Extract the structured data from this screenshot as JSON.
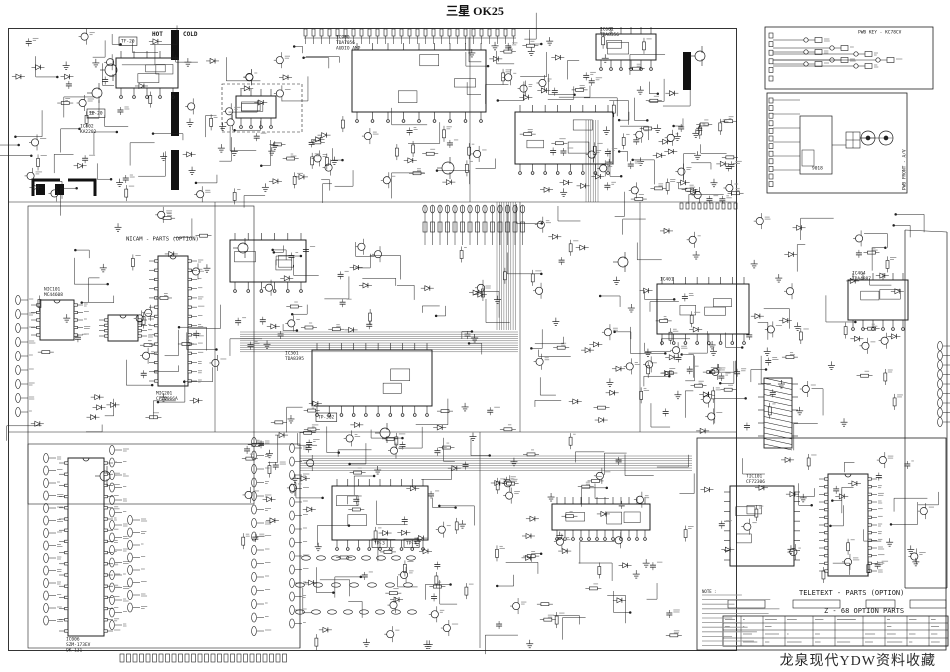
{
  "page": {
    "title": "三星 OK25",
    "watermark": "龙泉现代YDW资料收藏",
    "ink": "#1f1f1f",
    "faint": "#8f8f8f",
    "paper": "#ffffff"
  },
  "schematic": {
    "section_labels": [
      {
        "text": "HOT",
        "x": 152,
        "y": 30,
        "size": 6,
        "bold": true
      },
      {
        "text": "COLD",
        "x": 183,
        "y": 30,
        "size": 6,
        "bold": true
      },
      {
        "text": "NICAM - PARTS (OPTION)",
        "x": 126,
        "y": 235,
        "size": 5.5
      },
      {
        "text": "TELETEXT - PARTS (OPTION)",
        "x": 799,
        "y": 588,
        "size": 7
      },
      {
        "text": "Z - 68  OPTION PARTS",
        "x": 824,
        "y": 606,
        "size": 7
      },
      {
        "text": "PWB KEY - KC78CV",
        "x": 858,
        "y": 29,
        "size": 4.5
      },
      {
        "text": "PWB FRONT - A/V",
        "x": 901,
        "y": 190,
        "size": 4.5,
        "rot": -90
      },
      {
        "text": "MIC201\nCF70066A",
        "x": 156,
        "y": 390,
        "size": 4.5
      },
      {
        "text": "NIC101\nMC44608",
        "x": 44,
        "y": 286,
        "size": 4.5
      },
      {
        "text": "IC006\nSZM-173EV\nOK-131",
        "x": 66,
        "y": 636,
        "size": 4.5
      },
      {
        "text": "IC301\nTDA8395",
        "x": 285,
        "y": 350,
        "size": 4.5
      },
      {
        "text": "IC900\nTDA7056\nAUDIO AMP",
        "x": 336,
        "y": 34,
        "size": 4.5
      },
      {
        "text": "IC802\nKA2202",
        "x": 80,
        "y": 123,
        "size": 4.5
      },
      {
        "text": "IC404\nTDA4887",
        "x": 852,
        "y": 270,
        "size": 4.5
      },
      {
        "text": "TIC101\nCF72306",
        "x": 746,
        "y": 473,
        "size": 4.5
      },
      {
        "text": "IC601\nTDA8356",
        "x": 600,
        "y": 26,
        "size": 4.5
      },
      {
        "text": "IC401",
        "x": 660,
        "y": 276,
        "size": 4.5
      },
      {
        "text": "TF-20",
        "x": 121,
        "y": 38,
        "size": 4.5,
        "box": true
      },
      {
        "text": "TP-20",
        "x": 89,
        "y": 110,
        "size": 4.5,
        "box": true
      },
      {
        "text": "TP-302",
        "x": 318,
        "y": 414,
        "size": 4.5,
        "box": true
      },
      {
        "text": "TP-3",
        "x": 374,
        "y": 540,
        "size": 4.5,
        "box": true
      },
      {
        "text": "TP-4",
        "x": 406,
        "y": 540,
        "size": 4.5,
        "box": true
      },
      {
        "text": "9018",
        "x": 812,
        "y": 165,
        "size": 4.5
      },
      {
        "text": "NOTE :",
        "x": 702,
        "y": 589,
        "size": 4
      }
    ],
    "chips": {
      "flat": [
        {
          "x": 352,
          "y": 50,
          "w": 134,
          "h": 62,
          "pins": 9
        },
        {
          "x": 515,
          "y": 112,
          "w": 98,
          "h": 52,
          "pins": 8
        },
        {
          "x": 596,
          "y": 34,
          "w": 60,
          "h": 26,
          "pins": 6
        },
        {
          "x": 312,
          "y": 350,
          "w": 120,
          "h": 56,
          "pins": 10
        },
        {
          "x": 657,
          "y": 284,
          "w": 92,
          "h": 50,
          "pins": 8
        },
        {
          "x": 848,
          "y": 280,
          "w": 60,
          "h": 40,
          "pins": 6
        },
        {
          "x": 332,
          "y": 486,
          "w": 96,
          "h": 54,
          "pins": 9
        },
        {
          "x": 552,
          "y": 504,
          "w": 98,
          "h": 26,
          "pins": 12
        },
        {
          "x": 230,
          "y": 240,
          "w": 76,
          "h": 42,
          "pins": 6
        },
        {
          "x": 116,
          "y": 58,
          "w": 62,
          "h": 30,
          "pins": 5
        },
        {
          "x": 236,
          "y": 96,
          "w": 40,
          "h": 22,
          "pins": 4
        },
        {
          "x": 730,
          "y": 486,
          "w": 64,
          "h": 80,
          "pins": 8,
          "side": true
        }
      ],
      "dip": [
        {
          "x": 158,
          "y": 256,
          "w": 30,
          "h": 130,
          "pins": 14
        },
        {
          "x": 68,
          "y": 458,
          "w": 36,
          "h": 178,
          "pins": 16
        },
        {
          "x": 40,
          "y": 300,
          "w": 34,
          "h": 40,
          "pins": 5
        },
        {
          "x": 108,
          "y": 315,
          "w": 30,
          "h": 26,
          "pins": 4
        },
        {
          "x": 828,
          "y": 474,
          "w": 40,
          "h": 102,
          "pins": 13
        }
      ]
    }
  }
}
